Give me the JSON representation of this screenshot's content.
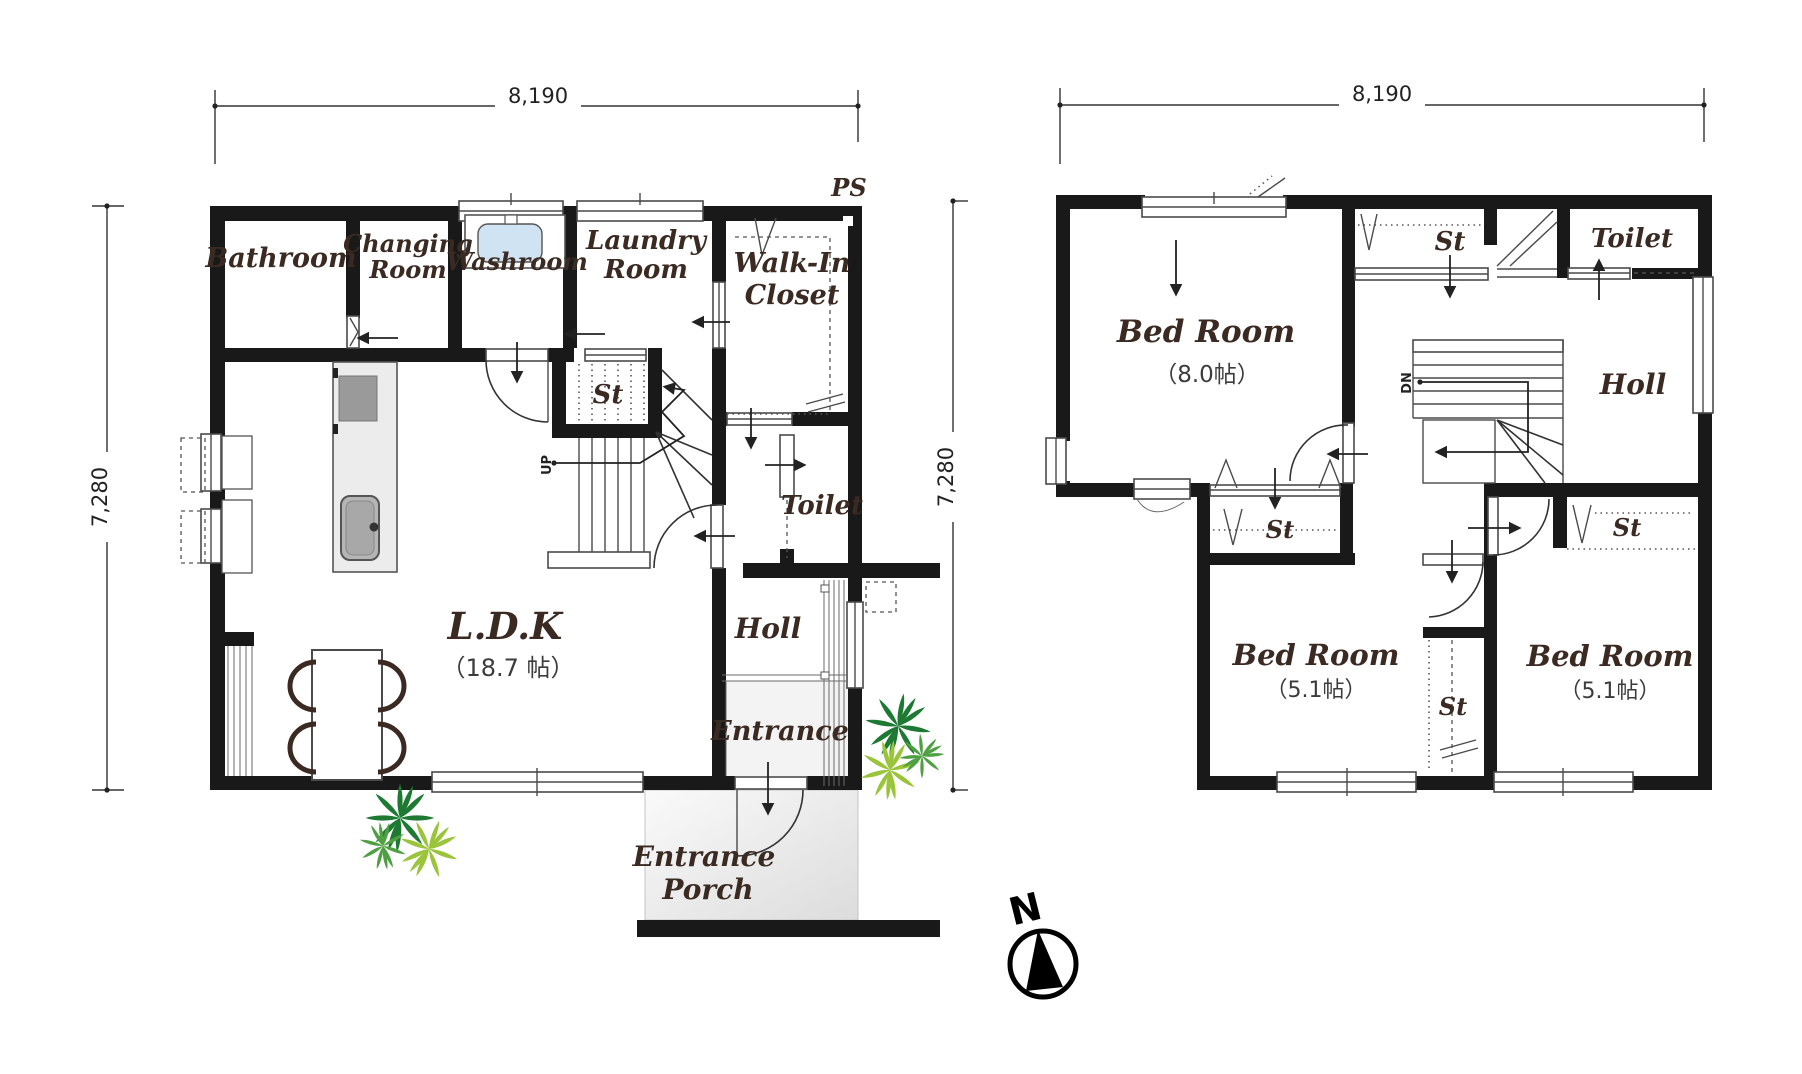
{
  "title": "Two-storey house floor plan",
  "floor1": {
    "dim_width": "8,190",
    "dim_height": "7,280",
    "ps": "PS",
    "up": "UP",
    "rooms": {
      "bathroom": "Bathroom",
      "changing_line1": "Changing",
      "changing_line2": "Room",
      "washroom": "Washroom",
      "laundry_line1": "Laundry",
      "laundry_line2": "Room",
      "wic_line1": "Walk-In",
      "wic_line2": "Closet",
      "st": "St",
      "toilet": "Toilet",
      "holl": "Holl",
      "entrance": "Entrance",
      "porch_line1": "Entrance",
      "porch_line2": "Porch",
      "ldk": "L.D.K",
      "ldk_size": "（18.7 帖）"
    }
  },
  "floor2": {
    "dim_width": "8,190",
    "dim_height": "7,280",
    "dn": "DN",
    "rooms": {
      "bedroom1": "Bed Room",
      "bedroom1_size": "（8.0帖）",
      "bedroom2": "Bed Room",
      "bedroom2_size": "（5.1帖）",
      "bedroom3": "Bed Room",
      "bedroom3_size": "（5.1帖）",
      "st_top": "St",
      "st_closet": "St",
      "st_mid": "St",
      "st_right": "St",
      "toilet": "Toilet",
      "holl": "Holl"
    }
  },
  "compass": {
    "north": "N"
  },
  "colors": {
    "wall": "#191919",
    "label": "#3a2a22",
    "sink_blue": "#cfe3f2",
    "stove_gray": "#9a9a9a",
    "porch_gray": "#e7e7e7",
    "plant_dark": "#1e7a33",
    "plant_mid": "#4ea043",
    "plant_light": "#9ac43a"
  }
}
